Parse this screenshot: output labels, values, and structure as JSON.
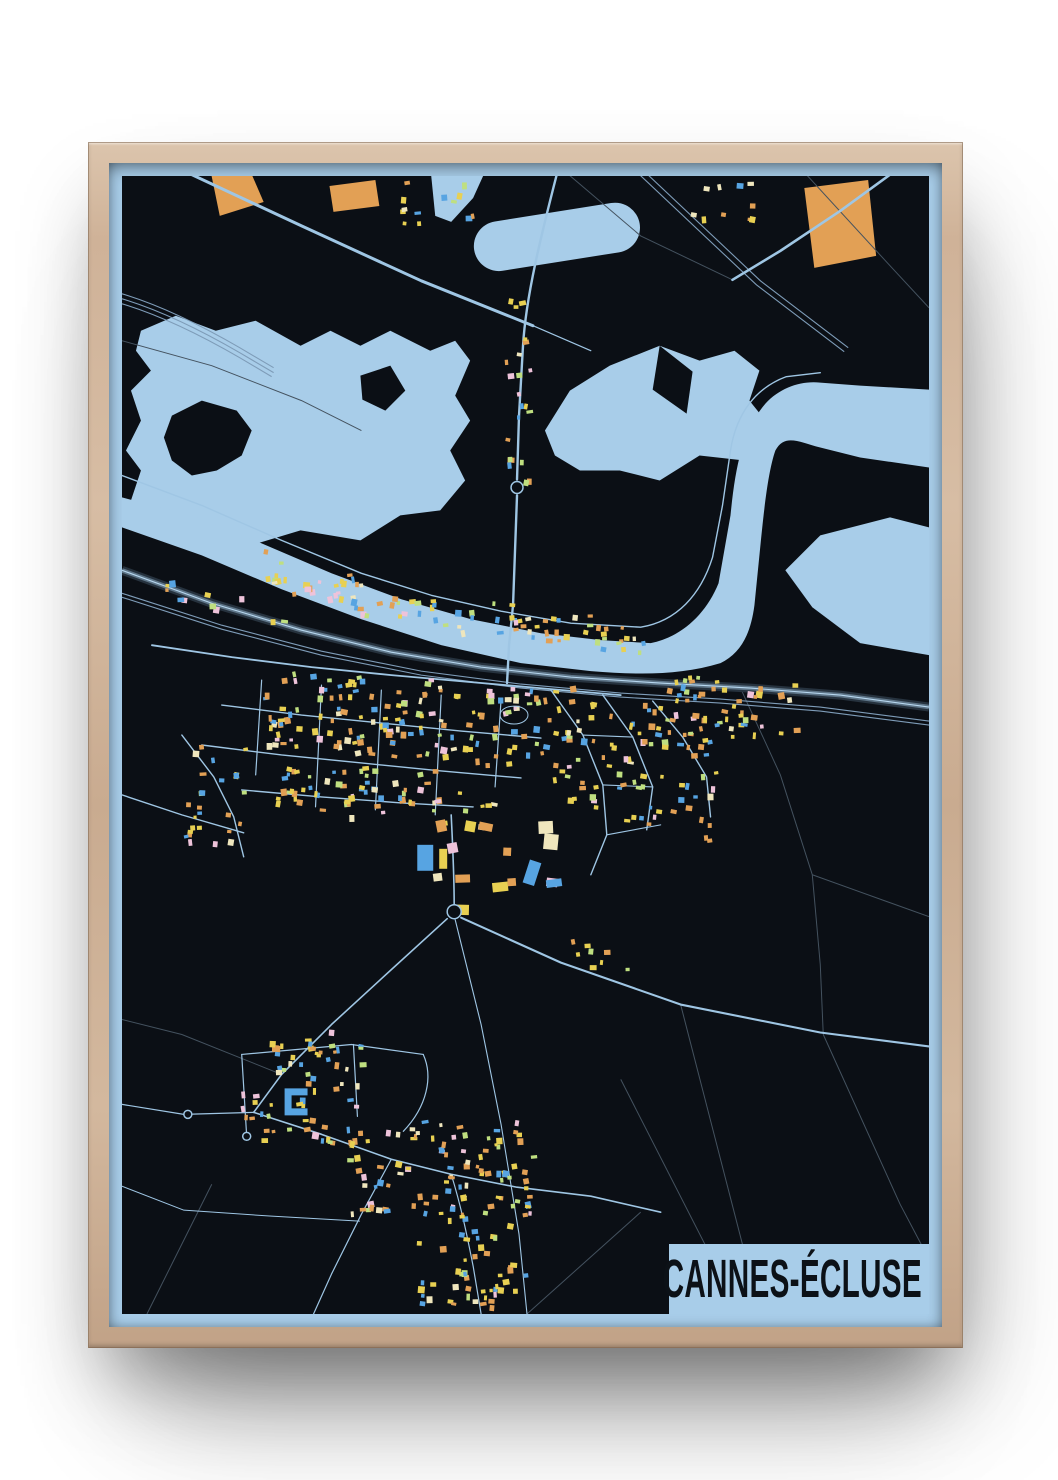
{
  "poster": {
    "title": "CANNES-ÉCLUSE"
  },
  "palette": {
    "page_background": "#ffffff",
    "frame_wood": "#cfb298",
    "poster_blue": "#a8cde9",
    "map_black": "#0b0f15",
    "water_blue": "#a8cde9",
    "road_light": "#9fc6e4",
    "road_bright": "#b7d7ef",
    "road_faint": "#44525f",
    "railway": "#7e9cb8",
    "highway_casing": "#26323e",
    "highway_fill": "#5e7588",
    "title_text": "#0c1117",
    "building_colors": {
      "yellow": "#e8d052",
      "orange": "#e2a055",
      "blue": "#57a4e2",
      "green": "#bfdf80",
      "pink": "#eec3da",
      "cream": "#efe6bd"
    }
  }
}
